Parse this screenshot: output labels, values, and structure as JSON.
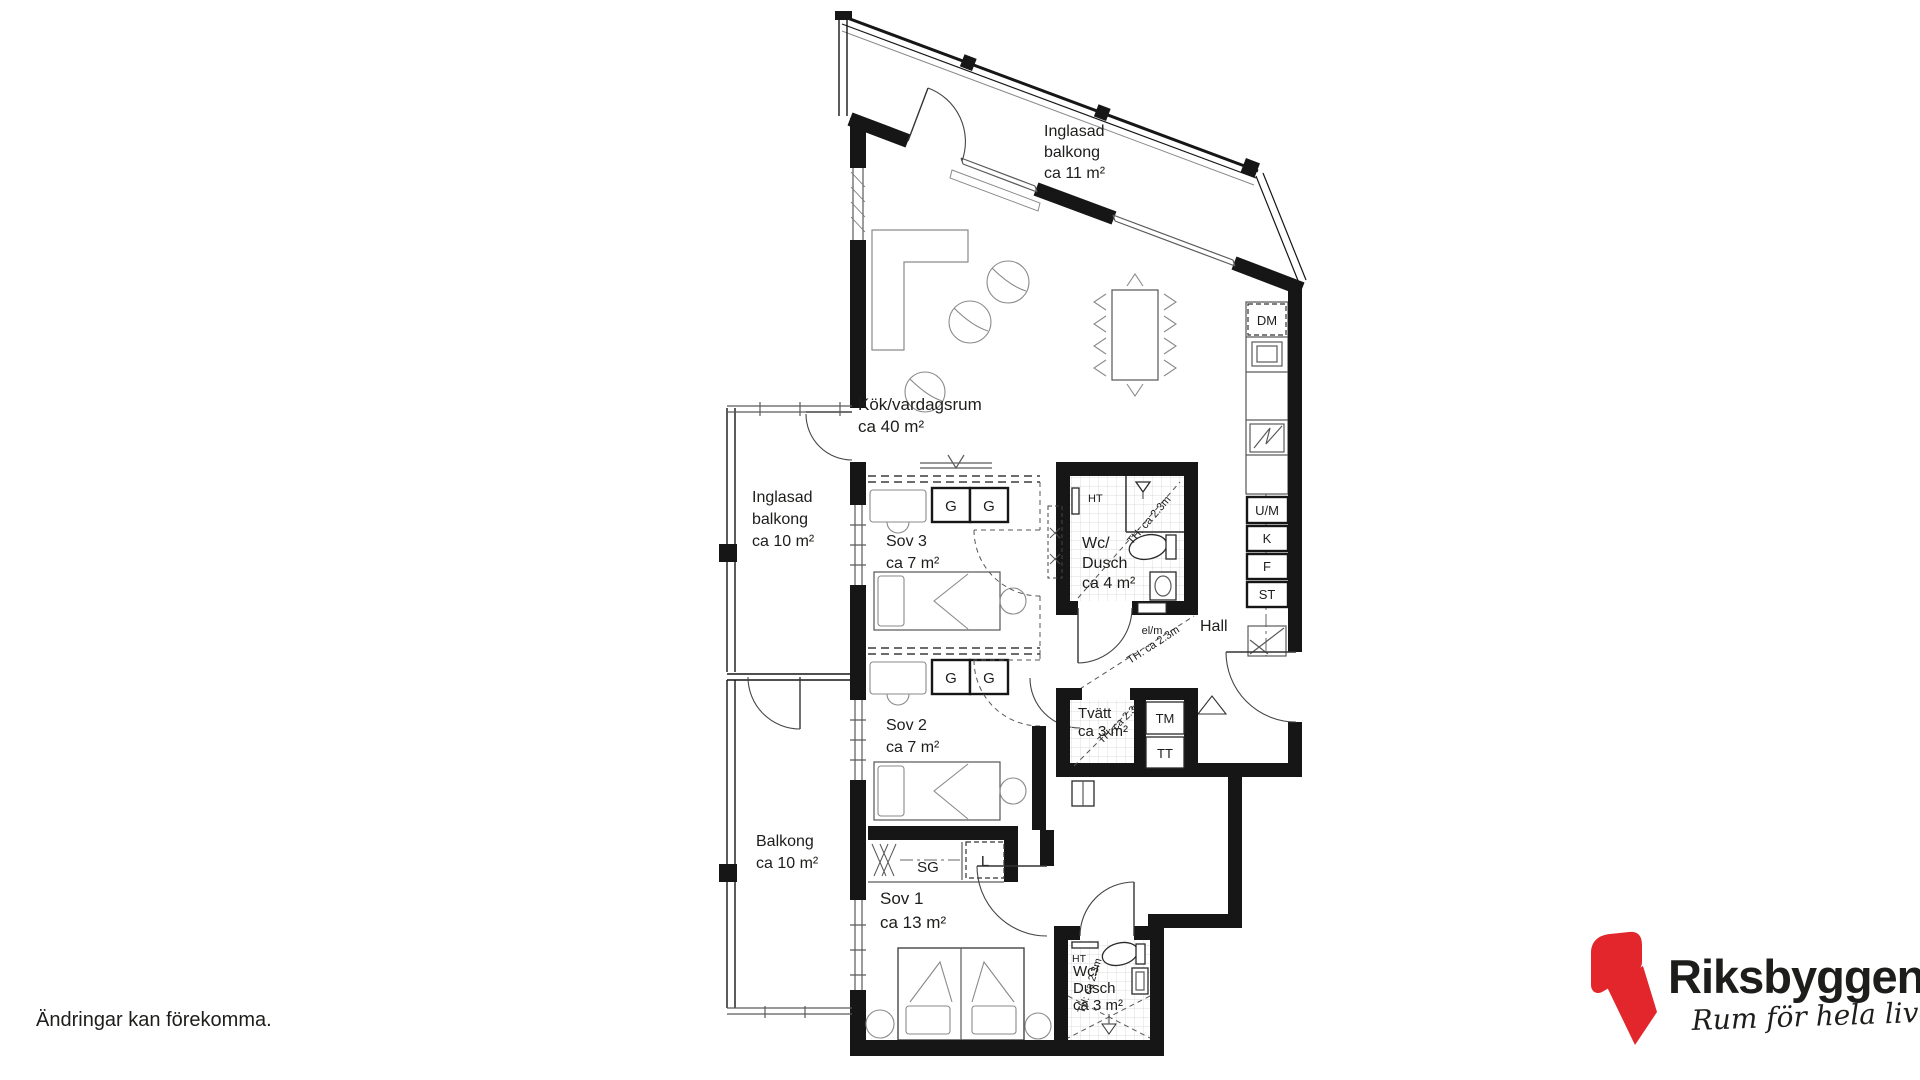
{
  "plan": {
    "ink": "#161616",
    "rooms": {
      "kok": {
        "lines": [
          "Kök/vardagsrum",
          "ca 40 m²"
        ]
      },
      "balkong_top": {
        "lines": [
          "Inglasad",
          "balkong",
          "ca 11 m²"
        ]
      },
      "balkong_mid": {
        "lines": [
          "Inglasad",
          "balkong",
          "ca 10 m²"
        ]
      },
      "balkong_low": {
        "lines": [
          "Balkong",
          "ca 10 m²"
        ]
      },
      "sov3": {
        "lines": [
          "Sov 3",
          "ca 7 m²"
        ]
      },
      "sov2": {
        "lines": [
          "Sov 2",
          "ca 7 m²"
        ]
      },
      "sov1": {
        "lines": [
          "Sov 1",
          "ca 13 m²"
        ]
      },
      "wc_dusch4": {
        "lines": [
          "Wc/",
          "Dusch",
          "ca 4 m²"
        ]
      },
      "wc_dusch3": {
        "lines": [
          "Wc/",
          "Dusch",
          "ca 3 m²"
        ]
      },
      "tvatt": {
        "lines": [
          "Tvätt",
          "ca 3 m²"
        ]
      },
      "hall": {
        "lines": [
          "Hall"
        ]
      }
    },
    "fixtures": {
      "dm": "DM",
      "um": "U/M",
      "kyl": "K",
      "frys": "F",
      "stad": "ST",
      "garderob": "G",
      "skjutdorrsgarderob": "SG",
      "linne": "L",
      "tvattmaskin": "TM",
      "torktumlare": "TT",
      "handdukstork": "HT",
      "elmatare": "el/m",
      "takhojd": "TH: ca 2.3m"
    }
  },
  "footer": {
    "disclaimer": "Ändringar kan förekomma."
  },
  "logo": {
    "brand": "Riksbyggen",
    "tagline": "Rum för hela livet",
    "red": "#e2262b",
    "gray": "#9c9b9b"
  }
}
